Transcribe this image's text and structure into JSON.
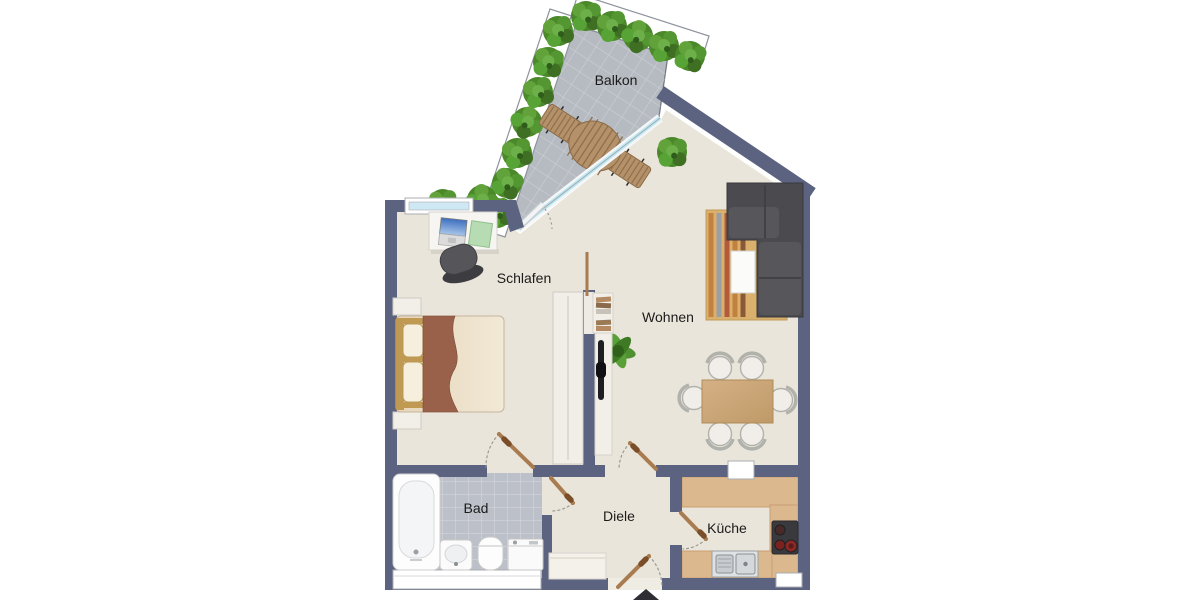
{
  "floorplan": {
    "rooms": {
      "balkon": {
        "label": "Balkon"
      },
      "schlafen": {
        "label": "Schlafen"
      },
      "wohnen": {
        "label": "Wohnen"
      },
      "bad": {
        "label": "Bad"
      },
      "diele": {
        "label": "Diele"
      },
      "kueche": {
        "label": "Küche"
      }
    },
    "entrance": {
      "marker": "triangle-up"
    },
    "colors": {
      "wall": "#5b6380",
      "floor": "#eae5da",
      "bath_tile": "#bcc0c8",
      "balcony_tile": "#b6bac1",
      "kitchen_counter": "#dcb88f",
      "door_wood": "#a87c50",
      "sofa": "#4b4b4f",
      "plant": "#4a8829",
      "glass": "#cfe9f4",
      "rug": "#d9b06c",
      "table_wood": "#c9a97c"
    }
  }
}
